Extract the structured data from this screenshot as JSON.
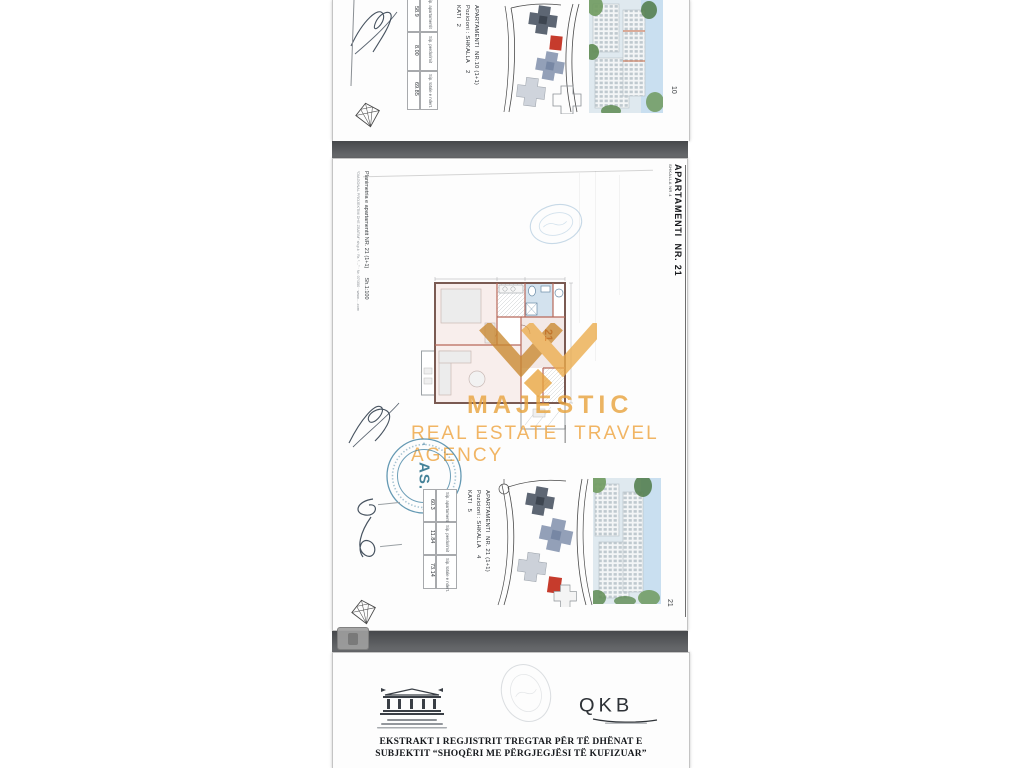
{
  "pages": {
    "top": {
      "table": {
        "rows": [
          {
            "label": "Sip. apartamentit",
            "value": "58.9"
          },
          {
            "label": "Sip. perdorimit",
            "value": "8.00"
          },
          {
            "label": "Sip. totale e ndert.",
            "value": "69.85"
          }
        ]
      },
      "caption": {
        "line1": "APARTAMENTI  NR.10 (1+1)",
        "line2": "Pozicioni : SHKALLA    2",
        "line3": "KATI   2"
      },
      "page_number": "10"
    },
    "middle": {
      "header_title": "APARTAMENTI  NR. 21",
      "header_subtitle": "SHKALLA NR.4",
      "side_title": "Planimetria e apartamentit NR. 21 (1+1)      Sh.1:100",
      "side_footer": "“DIAGONAL PROJEKTIM DHE ZBATIM” sh.p.k · Rr. “…” · Nr. 07/350 · www….com",
      "plan_unit_label": "21",
      "watermark": {
        "name": "MAJESTIC",
        "tagline_left": "REAL ESTATE",
        "tagline_right": "TRAVEL AGENCY"
      },
      "stamp_center": "AS.",
      "caption": {
        "line1": "APARTAMENTI  NR. 21 (1+1)",
        "line2": "Pozicioni : SHKALLA    4",
        "line3": "KATI   5"
      },
      "table": {
        "rows": [
          {
            "label": "Sip. apartamentit",
            "value": "60.3"
          },
          {
            "label": "Sip. perdorimit",
            "value": "11.84"
          },
          {
            "label": "Sip. totale e ndert.",
            "value": "73.14"
          }
        ]
      },
      "page_number": "21"
    },
    "bottom": {
      "registry_logo": "QKB",
      "title_line1": "EKSTRAKT I REGJISTRIT TREGTAR PËR TË DHËNAT E",
      "title_line2": "SUBJEKTIT “SHOQËRI ME PËRGJEGJËSI TË KUFIZUAR”"
    }
  },
  "colors": {
    "watermark_gold": "#E8A33C",
    "stamp_blue": "#3D7FA0",
    "highlight_red": "#C63B2C",
    "band_gray": "#55575A"
  }
}
